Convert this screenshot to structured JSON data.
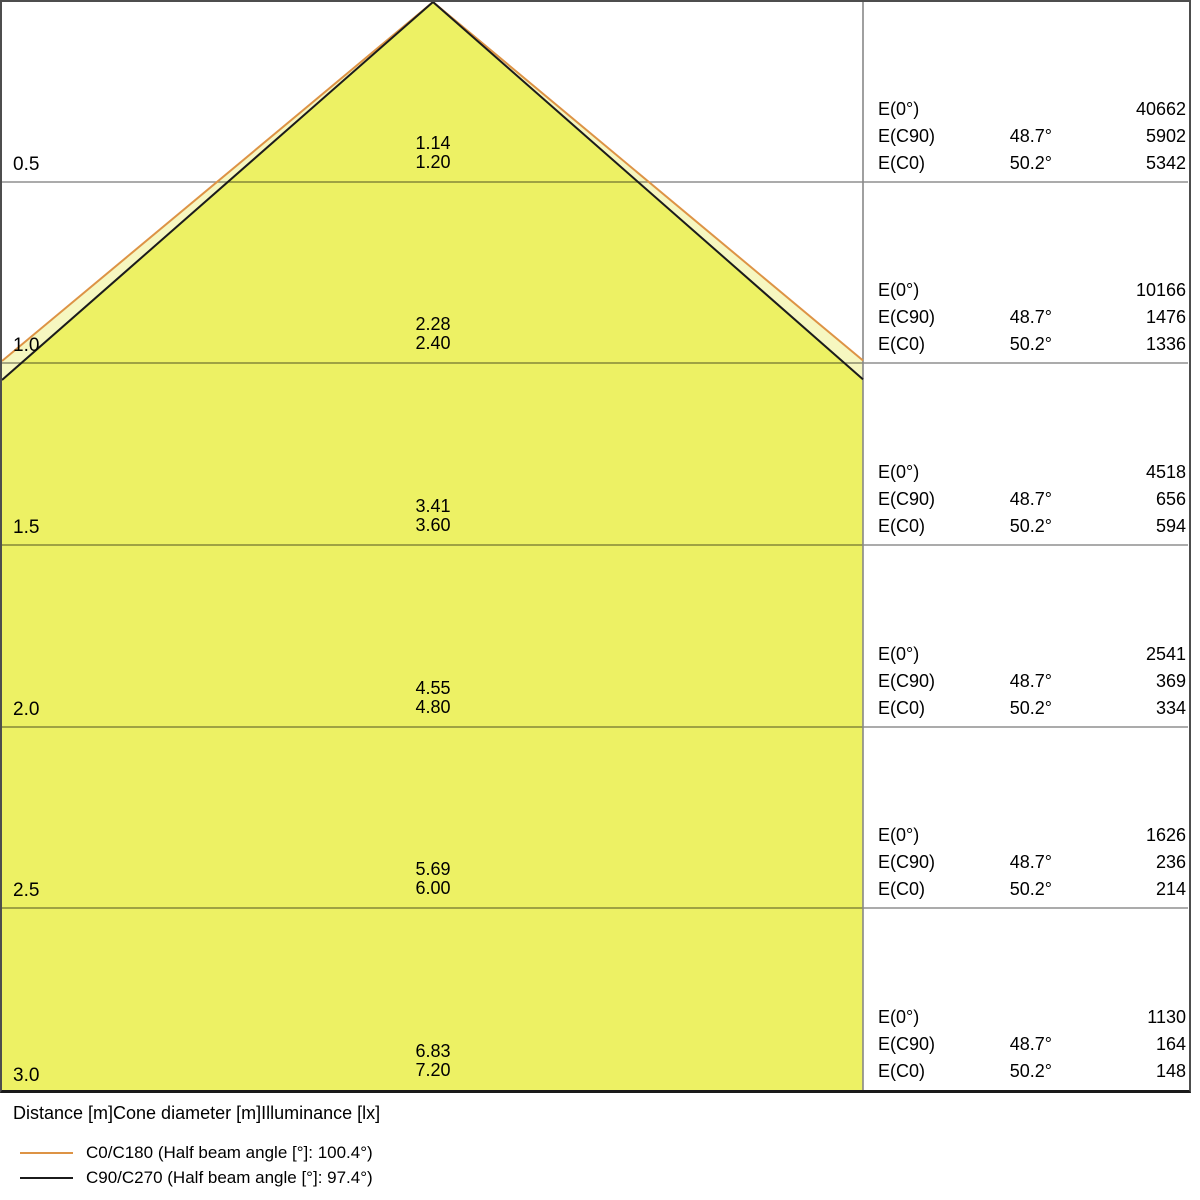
{
  "diagram": {
    "e_labels": {
      "e0": "E(0°)",
      "ec90": "E(C90)",
      "ec0": "E(C0)"
    },
    "rows": [
      {
        "distance": "0.5",
        "dia_c90": "1.14",
        "dia_c0": "1.20",
        "e0": "40662",
        "angle_c90": "48.7°",
        "e_c90": "5902",
        "angle_c0": "50.2°",
        "e_c0": "5342"
      },
      {
        "distance": "1.0",
        "dia_c90": "2.28",
        "dia_c0": "2.40",
        "e0": "10166",
        "angle_c90": "48.7°",
        "e_c90": "1476",
        "angle_c0": "50.2°",
        "e_c0": "1336"
      },
      {
        "distance": "1.5",
        "dia_c90": "3.41",
        "dia_c0": "3.60",
        "e0": "4518",
        "angle_c90": "48.7°",
        "e_c90": "656",
        "angle_c0": "50.2°",
        "e_c0": "594"
      },
      {
        "distance": "2.0",
        "dia_c90": "4.55",
        "dia_c0": "4.80",
        "e0": "2541",
        "angle_c90": "48.7°",
        "e_c90": "369",
        "angle_c0": "50.2°",
        "e_c0": "334"
      },
      {
        "distance": "2.5",
        "dia_c90": "5.69",
        "dia_c0": "6.00",
        "e0": "1626",
        "angle_c90": "48.7°",
        "e_c90": "236",
        "angle_c0": "50.2°",
        "e_c0": "214"
      },
      {
        "distance": "3.0",
        "dia_c90": "6.83",
        "dia_c0": "7.20",
        "e0": "1130",
        "angle_c90": "48.7°",
        "e_c90": "164",
        "angle_c0": "50.2°",
        "e_c0": "148"
      }
    ]
  },
  "caption": "Distance [m]Cone diameter [m]Illuminance [lx]",
  "legend": [
    {
      "label": "C0/C180 (Half beam angle [°]: 100.4°)",
      "color": "#dd9345"
    },
    {
      "label": "C90/C270 (Half beam angle [°]: 97.4°)",
      "color": "#1b1b1b"
    }
  ],
  "colors": {
    "cone_fill": "#edf164",
    "cone_fill_outer": "#f6f7c0",
    "c0_line": "#dd9345",
    "c90_line": "#1b1b1b",
    "gridline": "#8f8f8f",
    "panel_divider": "#888888",
    "border": "#4d4d4d"
  }
}
